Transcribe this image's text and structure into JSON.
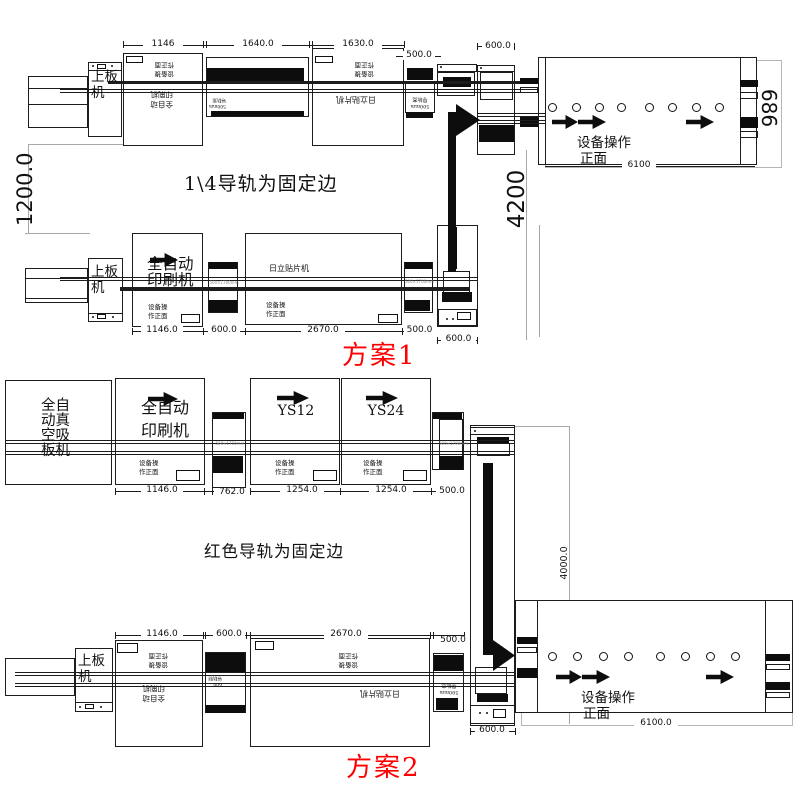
{
  "plans": {
    "plan1": {
      "name": "方案1",
      "caption": "1\\4导轨为固定边"
    },
    "plan2": {
      "name": "方案2",
      "caption": "红色导轨为固定边"
    }
  },
  "machines": {
    "loader": "上板机",
    "printer": "全自动印刷机",
    "mounter": "日立贴片机",
    "vacuum_loader": "全自动真空吸板机",
    "ys12": "YS12",
    "ys24": "YS24"
  },
  "labels": {
    "front_b1": "设备操作",
    "front_b2": "正面",
    "front_s1": "设备操",
    "front_s2": "作正面",
    "rail_l1": "500mm",
    "rail_l2": "导轨宽",
    "conn_label": "500×1700mm",
    "d2_l1": "600",
    "d2_l2": "导轨制"
  },
  "dimensions": {
    "p1_top": {
      "printer": "1146",
      "m2": "1640.0",
      "m3": "1630.0",
      "conn": "500.0",
      "corner": "600.0",
      "conveyor": "6100",
      "conveyor_width": "686",
      "row_gap": "1200.0",
      "vertical": "4200"
    },
    "p1_bottom": {
      "printer": "1146.0",
      "conn1": "600.0",
      "mounter": "2670.0",
      "conn2": "500.0",
      "corner": "600.0"
    },
    "p2_top": {
      "printer": "1146.0",
      "conn1": "762.0",
      "ys12": "1254.0",
      "ys24": "1254.0",
      "conn2": "500.0",
      "vertical": "4000.0"
    },
    "p2_bottom": {
      "printer": "1146.0",
      "conn1": "600.0",
      "mounter": "2670.0",
      "conn2": "500.0",
      "corner": "600.0",
      "conveyor": "6100.0"
    }
  }
}
